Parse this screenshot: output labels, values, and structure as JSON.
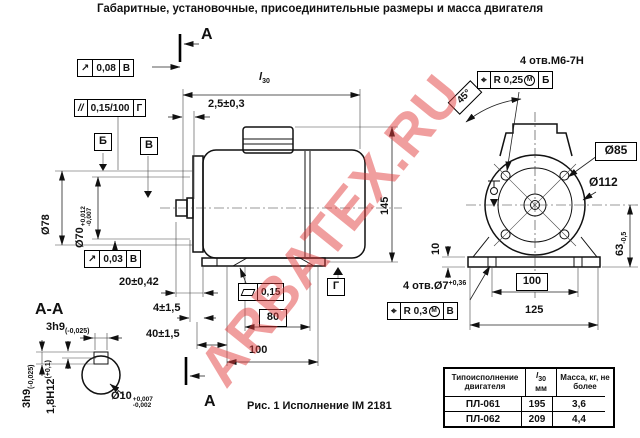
{
  "title": "Габаритные, установочные, присоединительные размеры и масса двигателя",
  "watermark": {
    "text": "ARBATEX.RU",
    "color": "#e23e3e"
  },
  "labels": {
    "section_top": "А",
    "section_bottom": "А",
    "section_view": "А-А",
    "caption": "Рис. 1 Исполнение IM 2181"
  },
  "datums": {
    "b": "Б",
    "v": "В",
    "g": "Г"
  },
  "gdt": {
    "runout_top": {
      "sym": "↗",
      "val": "0,08",
      "ref": "В"
    },
    "parallelism": {
      "sym": "//",
      "val": "0,15/100",
      "ref": "Г"
    },
    "runout_bottom": {
      "sym": "↗",
      "val": "0,03",
      "ref": "В"
    },
    "flatness": {
      "val": "0,15"
    },
    "position_flange": {
      "sym": "⌖",
      "val": "R 0,25",
      "mod": "M",
      "ref": "Б"
    },
    "position_feet": {
      "sym": "⌖",
      "val": "R 0,3",
      "mod": "M",
      "ref": "В"
    }
  },
  "dims": {
    "l30": {
      "main": "l",
      "sub": "30"
    },
    "gap": "2,5±0,3",
    "d78": "Ø78",
    "d70": {
      "main": "Ø70",
      "up": "+0,012",
      "dn": "-0,007"
    },
    "h145": "145",
    "shaft_len": "20±0,42",
    "key_off": "4±1,5",
    "key_len": "40±1,5",
    "feet80": "80",
    "feet100": "100",
    "flange_holes": "4 отв.М6-7Н",
    "angle": "45°",
    "d85": "Ø85",
    "d112": "Ø112",
    "h63": {
      "main": "63",
      "dn": "-0,5"
    },
    "plate10": "10",
    "base100": "100",
    "base125": "125",
    "feet_holes": {
      "main": "4 отв.Ø7",
      "up": "+0,36"
    },
    "key_w_top": {
      "main": "3h9",
      "dn": "(-0,025)"
    },
    "key_w_side": {
      "main": "3h9",
      "dn": "(-0,025)"
    },
    "key_h": {
      "main": "1,8H12",
      "up": "(+0,1)"
    },
    "d10": {
      "main": "Ø10",
      "up": "+0,007",
      "dn": "-0,002"
    }
  },
  "table": {
    "header_model": "Типоисполнение двигателя",
    "header_l30": {
      "main": "l",
      "sub": "30",
      "unit": "мм"
    },
    "header_mass": "Масса, кг, не более",
    "rows": [
      {
        "model": "ПЛ-061",
        "l30": "195",
        "mass": "3,6"
      },
      {
        "model": "ПЛ-062",
        "l30": "209",
        "mass": "4,4"
      }
    ]
  }
}
